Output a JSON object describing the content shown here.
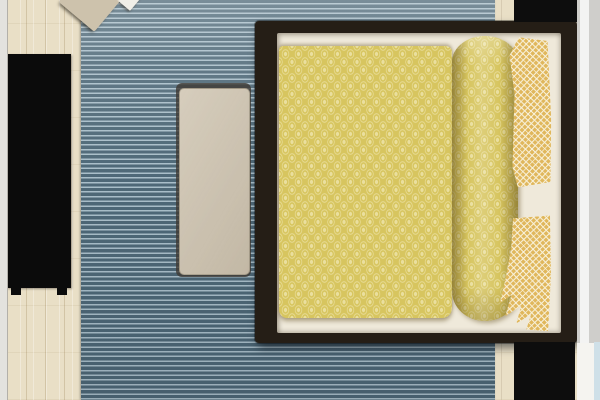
{
  "scene": {
    "kind": "bedroom-floor-plan-top-view",
    "text_content": "none (image contains no visible text)"
  },
  "palette": {
    "wall_left": "#e3e2de",
    "wall_right": "#cfcecb",
    "wall_right_lower": "#f5f4f0",
    "window_sliver": "#cfe0e8",
    "wood_floor": "#e9dfc6",
    "rug_dark": "#4e6877",
    "rug_light": "#a9bec9",
    "bed_frame": "#251e16",
    "mattress_sheet": "#efe9da",
    "duvet_yellow": "#d7c55f",
    "duvet_motif": "#eadf9e",
    "pillow_gold": "#e0b75c",
    "pillow_lattice": "#f8f1da",
    "bench": "#cdc2ae",
    "bench_edge": "#3f3a33",
    "wardrobe": "#0b0b0b",
    "nightstand": "#0d0d0d",
    "chair_seat": "#cdc2ac",
    "chair_throw": "#f1efe8"
  },
  "objects": [
    {
      "name": "rug",
      "description": "blue horizontally striped area rug"
    },
    {
      "name": "bed",
      "description": "dark-framed double bed, yellow medallion duvet, folded duvet roll, gold lattice pillows"
    },
    {
      "name": "bench",
      "description": "beige upholstered bench left of bed"
    },
    {
      "name": "wardrobe",
      "description": "black wardrobe on left wall with feet"
    },
    {
      "name": "nightstand-top",
      "description": "black nightstand, top-right corner"
    },
    {
      "name": "nightstand-bottom",
      "description": "black nightstand, bottom-right corner"
    },
    {
      "name": "accent-chair",
      "description": "rotated beige chair with white throw, top-left, cut by image edge"
    },
    {
      "name": "wood-floor",
      "description": "light plank flooring visible at room edges"
    }
  ]
}
